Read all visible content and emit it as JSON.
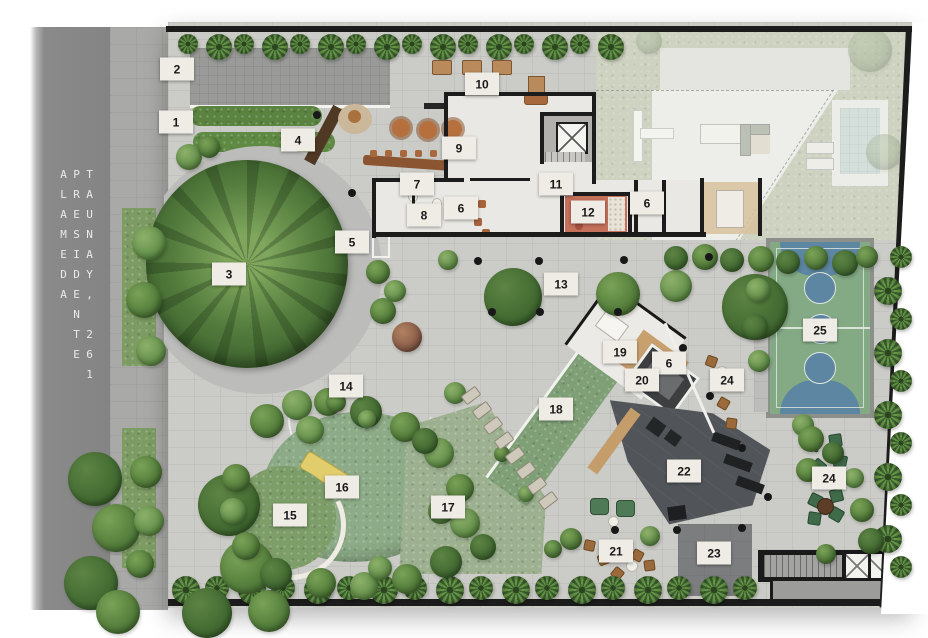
{
  "street": {
    "label": "ALAMEDA PRESIDENTE TAUNAY, 261"
  },
  "markers": [
    {
      "n": "1",
      "x": 176,
      "y": 122
    },
    {
      "n": "2",
      "x": 177,
      "y": 69
    },
    {
      "n": "3",
      "x": 229,
      "y": 274
    },
    {
      "n": "4",
      "x": 298,
      "y": 140
    },
    {
      "n": "5",
      "x": 352,
      "y": 242
    },
    {
      "n": "6",
      "x": 461,
      "y": 208
    },
    {
      "n": "6",
      "x": 647,
      "y": 203
    },
    {
      "n": "6",
      "x": 669,
      "y": 363
    },
    {
      "n": "7",
      "x": 417,
      "y": 184
    },
    {
      "n": "8",
      "x": 424,
      "y": 215
    },
    {
      "n": "9",
      "x": 459,
      "y": 148
    },
    {
      "n": "10",
      "x": 482,
      "y": 84
    },
    {
      "n": "11",
      "x": 556,
      "y": 184
    },
    {
      "n": "12",
      "x": 588,
      "y": 212
    },
    {
      "n": "13",
      "x": 561,
      "y": 284
    },
    {
      "n": "14",
      "x": 346,
      "y": 386
    },
    {
      "n": "15",
      "x": 290,
      "y": 515
    },
    {
      "n": "16",
      "x": 342,
      "y": 487
    },
    {
      "n": "17",
      "x": 448,
      "y": 507
    },
    {
      "n": "18",
      "x": 556,
      "y": 409
    },
    {
      "n": "19",
      "x": 620,
      "y": 352
    },
    {
      "n": "20",
      "x": 642,
      "y": 380
    },
    {
      "n": "21",
      "x": 616,
      "y": 551
    },
    {
      "n": "22",
      "x": 684,
      "y": 471
    },
    {
      "n": "23",
      "x": 714,
      "y": 553
    },
    {
      "n": "24",
      "x": 727,
      "y": 380
    },
    {
      "n": "24",
      "x": 829,
      "y": 478
    },
    {
      "n": "25",
      "x": 820,
      "y": 330
    }
  ],
  "palette": {
    "street": "#8a8a8a",
    "sidewalk": "#a9a9a7",
    "paving": "#cbcbc7",
    "greenery": "#4f7a3a",
    "court_green": "#83a985",
    "court_blue": "#5d86a3",
    "gym": "#53565a",
    "terracotta": "#c4705b",
    "wood": "#b5703d",
    "pool": "#c2d4d2",
    "playground": "#8cab86",
    "label_bg": "#efece6",
    "label_text": "#191919",
    "wall": "#1d1d1d"
  }
}
